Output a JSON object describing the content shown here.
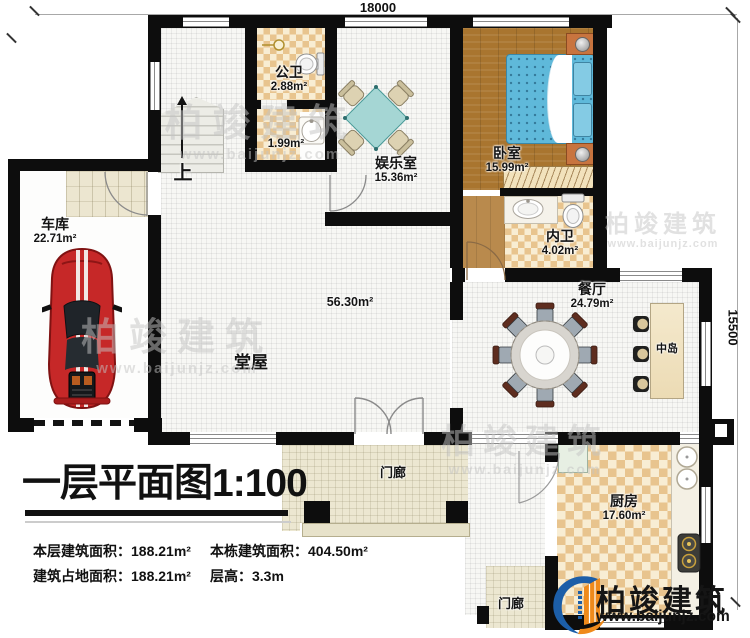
{
  "dimensions": {
    "width_mm": "18000",
    "height_mm": "15500"
  },
  "title": {
    "main": "一层平面图",
    "scale": "1:100"
  },
  "stats": [
    {
      "label": "本层建筑面积：",
      "value": "188.21m²"
    },
    {
      "label": "本栋建筑面积：",
      "value": "404.50m²"
    },
    {
      "label": "建筑占地面积：",
      "value": "188.21m²"
    },
    {
      "label": "层高：",
      "value": "3.3m"
    }
  ],
  "rooms": {
    "garage": {
      "name": "车库",
      "area": "22.71m²"
    },
    "public_bath": {
      "name": "公卫",
      "area": "2.88m²"
    },
    "washroom": {
      "area": "1.99m²"
    },
    "entertainment": {
      "name": "娱乐室",
      "area": "15.36m²"
    },
    "bedroom": {
      "name": "卧室",
      "area": "15.99m²"
    },
    "ensuite_bath": {
      "name": "内卫",
      "area": "4.02m²"
    },
    "dining": {
      "name": "餐厅",
      "area": "24.79m²"
    },
    "hall": {
      "name": "堂屋",
      "area": "56.30m²"
    },
    "kitchen": {
      "name": "厨房",
      "area": "17.60m²"
    },
    "island": {
      "name": "中岛"
    },
    "porch_front": {
      "name": "门廊"
    },
    "porch_side": {
      "name": "门廊"
    },
    "stairs": {
      "up_label": "上"
    }
  },
  "brand": {
    "name": "柏竣建筑",
    "website": "www.baijunjz.com"
  },
  "watermark": {
    "name": "柏竣建筑",
    "website": "www.baijunjz.com"
  },
  "colors": {
    "wall": "#0d0d0d",
    "logo_blue": "#1c5ea8",
    "logo_orange": "#ef8a1b",
    "bed_blue": "#5fb9da",
    "car_red": "#c62828",
    "table_teal": "#a5d6d4",
    "checker_tan": "#e8c48e",
    "wood_brown": "#a9752f",
    "porch_beige": "#ece7d1"
  }
}
